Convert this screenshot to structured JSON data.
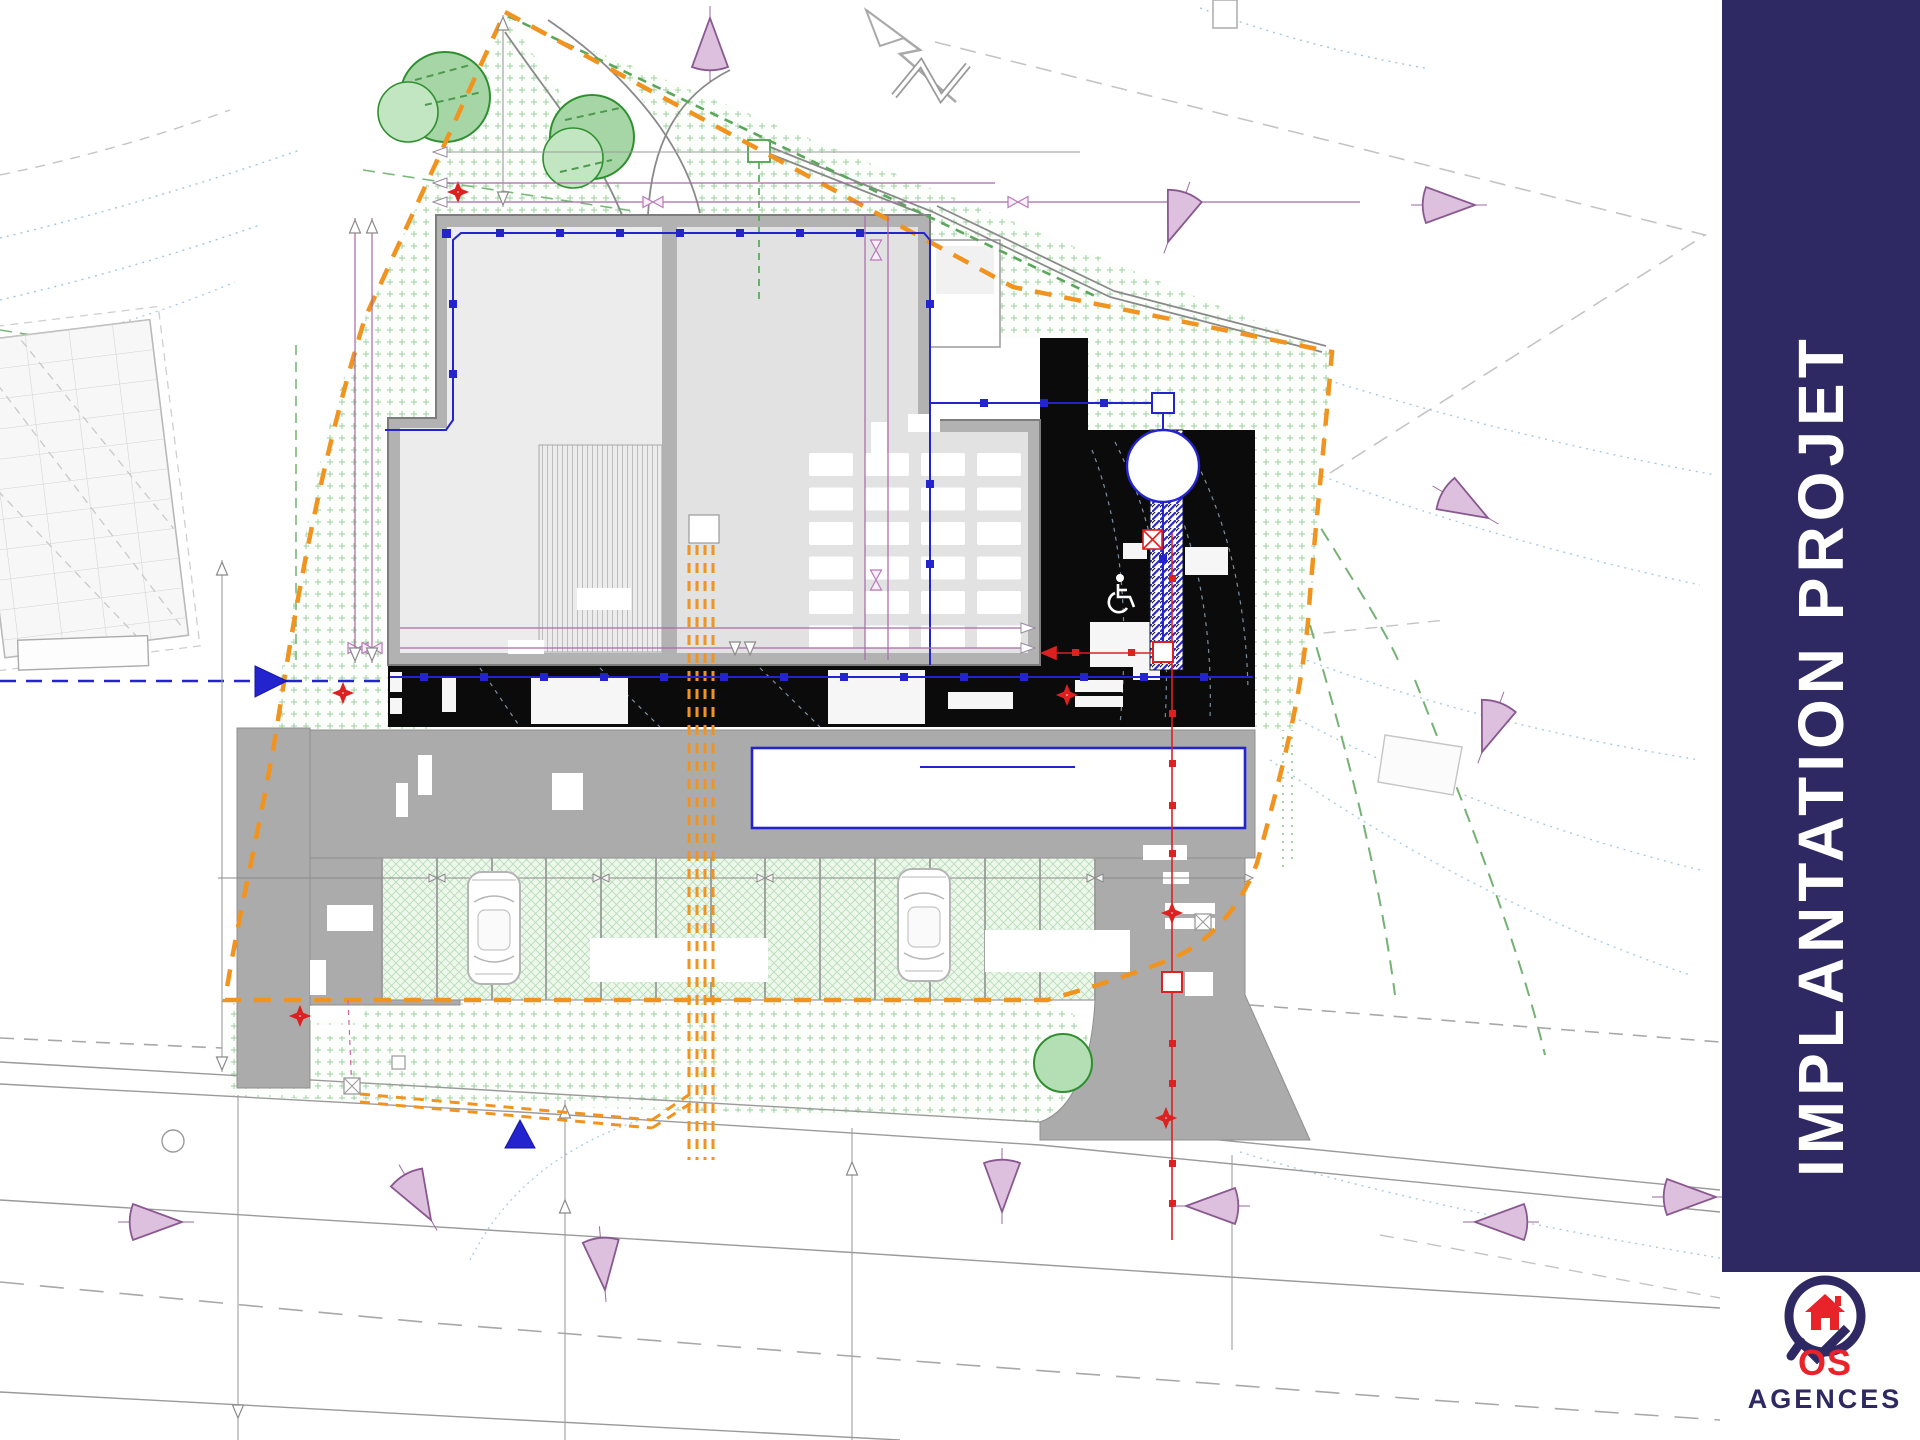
{
  "sidebar": {
    "title": "IMPLANTATION PROJET"
  },
  "brand": {
    "full_name": "VOS AGENCES",
    "vos_suffix": "OS",
    "agences": "AGENCES"
  },
  "plan": {
    "type": "site-plan",
    "accessible_icon": "wheelchair",
    "north_icon": "north-arrow"
  },
  "icons": {
    "accessibility": "wheelchair-icon",
    "north": "north-arrow-icon",
    "brand_house": "house-icon",
    "brand_check": "check-icon"
  },
  "colors": {
    "navy": "#2e2963",
    "orange": "#f0941f",
    "blue": "#2424cf",
    "red": "#dd2020",
    "purple_dim": "#a868a8",
    "cone_fill": "#dcc0de",
    "cone_stroke": "#8a5890",
    "logo_red": "#e8232a",
    "roof_light": "#ececec",
    "roof_mid": "#e2e2e2",
    "wall_gray": "#b2b2b2",
    "paving_gray": "#ababab",
    "black_zone": "#0b0b0b",
    "veg_green": "#8cc98c",
    "hedge_green": "#5aa65a"
  }
}
